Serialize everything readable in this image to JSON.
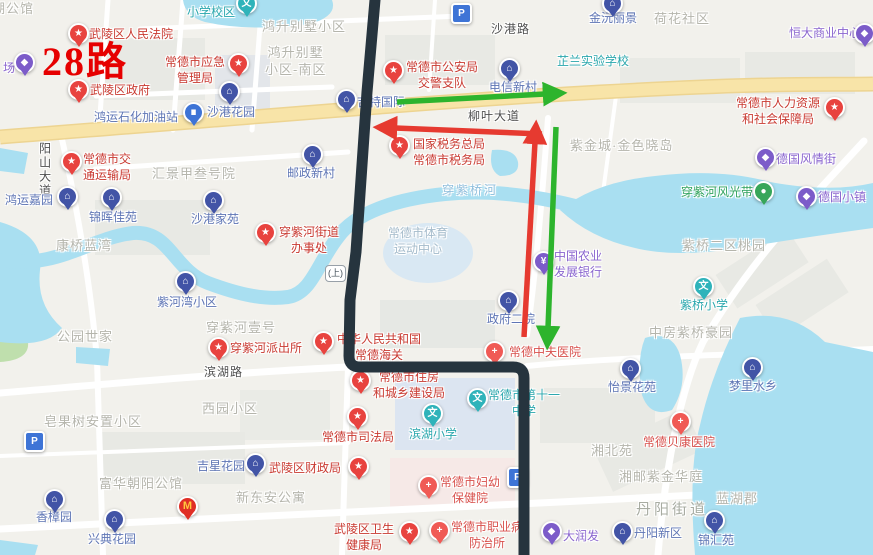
{
  "route_overlay": {
    "route_number": "28路",
    "bridge_badge": "(上)",
    "colors": {
      "route_line": "#26343E",
      "arrow_red": "#E63A30",
      "arrow_green": "#2DB42D",
      "water": "#A9DFF1",
      "major_road": "#F8E4A8",
      "land": "#F2F1EC"
    }
  },
  "labels": [
    {
      "t": "湖公馆",
      "k": "area",
      "x": -8,
      "y": 1
    },
    {
      "t": "场",
      "k": "shop",
      "x": 3,
      "y": 61,
      "px": 24,
      "py": 62
    },
    {
      "t": "28路",
      "k": "route-badge",
      "x": 42,
      "y": 36
    },
    {
      "t": "武陵区人民法院",
      "k": "gov",
      "x": 89,
      "y": 27,
      "px": 78,
      "py": 33
    },
    {
      "t": "常德市应急\n管理局",
      "k": "gov",
      "x": 165,
      "y": 55,
      "px": 238,
      "py": 63
    },
    {
      "t": "武陵区政府",
      "k": "gov",
      "x": 90,
      "y": 83,
      "px": 78,
      "py": 89
    },
    {
      "t": "鸿运石化加油站",
      "k": "gas",
      "x": 94,
      "y": 110,
      "px": 193,
      "py": 112
    },
    {
      "t": "沙港花园",
      "k": "resid",
      "x": 207,
      "y": 105,
      "px": 229,
      "py": 91
    },
    {
      "t": "小学校区",
      "k": "school",
      "x": 187,
      "y": 5,
      "px": 246,
      "py": 3
    },
    {
      "t": "鸿升别墅小区",
      "k": "area",
      "x": 262,
      "y": 19
    },
    {
      "t": "鸿升别墅\n小区-南区",
      "k": "area",
      "x": 265,
      "y": 45
    },
    {
      "t": "沙港路",
      "k": "road",
      "x": 491,
      "y": 22
    },
    {
      "t": "金沅丽景",
      "k": "resid",
      "x": 589,
      "y": 11,
      "px": 612,
      "py": 3
    },
    {
      "t": "荷花社区",
      "k": "area",
      "x": 654,
      "y": 11
    },
    {
      "t": "恒大商业中心",
      "k": "shop",
      "x": 789,
      "y": 26,
      "px": 864,
      "py": 33
    },
    {
      "t": "芷兰实验学校",
      "k": "school",
      "x": 557,
      "y": 54
    },
    {
      "t": "常德市公安局\n交警支队",
      "k": "gov",
      "x": 406,
      "y": 60,
      "px": 393,
      "py": 70
    },
    {
      "t": "吉特国际",
      "k": "resid",
      "x": 357,
      "y": 95,
      "px": 346,
      "py": 99
    },
    {
      "t": "电信新村",
      "k": "resid",
      "x": 489,
      "y": 80,
      "px": 509,
      "py": 68
    },
    {
      "t": "柳叶大道",
      "k": "road",
      "x": 468,
      "y": 109
    },
    {
      "t": "常德市人力资源\n和社会保障局",
      "k": "gov",
      "x": 736,
      "y": 96,
      "px": 834,
      "py": 107
    },
    {
      "t": "紫金城·金色晓岛",
      "k": "area",
      "x": 570,
      "y": 138
    },
    {
      "t": "德国风情街",
      "k": "shop",
      "x": 776,
      "y": 152,
      "px": 765,
      "py": 157
    },
    {
      "t": "穿紫河风光带",
      "k": "scenic",
      "x": 681,
      "y": 185,
      "px": 763,
      "py": 191
    },
    {
      "t": "德国小镇",
      "k": "shop",
      "x": 818,
      "y": 190,
      "px": 806,
      "py": 196
    },
    {
      "t": "阳山大道",
      "k": "road-v",
      "x": 36,
      "y": 142
    },
    {
      "t": "常德市交\n通运输局",
      "k": "gov",
      "x": 83,
      "y": 152,
      "px": 71,
      "py": 161
    },
    {
      "t": "汇景甲叁号院",
      "k": "area",
      "x": 152,
      "y": 166
    },
    {
      "t": "邮政新村",
      "k": "resid",
      "x": 287,
      "y": 166,
      "px": 312,
      "py": 154
    },
    {
      "t": "国家税务总局\n常德市税务局",
      "k": "gov",
      "x": 413,
      "y": 137,
      "px": 399,
      "py": 145
    },
    {
      "t": "穿紫桥河",
      "k": "water",
      "x": 442,
      "y": 183
    },
    {
      "t": "鸿运嘉园",
      "k": "resid",
      "x": 5,
      "y": 193,
      "px": 67,
      "py": 196
    },
    {
      "t": "锦晖佳苑",
      "k": "resid",
      "x": 89,
      "y": 210,
      "px": 111,
      "py": 197
    },
    {
      "t": "沙港家苑",
      "k": "resid",
      "x": 191,
      "y": 212,
      "px": 213,
      "py": 200
    },
    {
      "t": "穿紫河街道\n办事处",
      "k": "gov",
      "x": 279,
      "y": 225,
      "px": 265,
      "py": 232
    },
    {
      "t": "康桥蓝湾",
      "k": "area",
      "x": 56,
      "y": 238
    },
    {
      "t": "常德市体育\n运动中心",
      "k": "venue",
      "x": 388,
      "y": 226
    },
    {
      "t": "中国农业\n发展银行",
      "k": "bank",
      "x": 554,
      "y": 249,
      "px": 543,
      "py": 261
    },
    {
      "t": "紫桥二区桃园",
      "k": "area",
      "x": 682,
      "y": 238
    },
    {
      "t": "紫河湾小区",
      "k": "resid",
      "x": 157,
      "y": 295,
      "px": 185,
      "py": 281
    },
    {
      "t": "紫桥小学",
      "k": "school",
      "x": 680,
      "y": 298,
      "px": 703,
      "py": 286
    },
    {
      "t": "政府二院",
      "k": "resid",
      "x": 487,
      "y": 312,
      "px": 508,
      "py": 300
    },
    {
      "t": "公园世家",
      "k": "area",
      "x": 57,
      "y": 329
    },
    {
      "t": "穿紫河壹号",
      "k": "area",
      "x": 206,
      "y": 320
    },
    {
      "t": "穿紫河派出所",
      "k": "gov",
      "x": 230,
      "y": 341,
      "px": 218,
      "py": 347
    },
    {
      "t": "中华人民共和国\n常德海关",
      "k": "gov",
      "x": 337,
      "y": 332,
      "px": 323,
      "py": 341
    },
    {
      "t": "常德中夫医院",
      "k": "hosp",
      "x": 509,
      "y": 345,
      "px": 494,
      "py": 351
    },
    {
      "t": "中房紫桥豪园",
      "k": "area",
      "x": 649,
      "y": 325
    },
    {
      "t": "滨湖路",
      "k": "road",
      "x": 204,
      "y": 365
    },
    {
      "t": "西园小区",
      "k": "area",
      "x": 202,
      "y": 401
    },
    {
      "t": "常德市住房\n和城乡建设局",
      "k": "gov",
      "x": 373,
      "y": 370,
      "px": 360,
      "py": 380
    },
    {
      "t": "常德市第十一\n中学",
      "k": "school",
      "x": 488,
      "y": 388,
      "px": 477,
      "py": 398
    },
    {
      "t": "滨湖小学",
      "k": "school",
      "x": 409,
      "y": 427,
      "px": 432,
      "py": 413
    },
    {
      "t": "怡景花苑",
      "k": "resid",
      "x": 608,
      "y": 380,
      "px": 630,
      "py": 368
    },
    {
      "t": "梦里水乡",
      "k": "resid",
      "x": 729,
      "y": 379,
      "px": 752,
      "py": 367
    },
    {
      "t": "皂果树安置小区",
      "k": "area",
      "x": 44,
      "y": 414
    },
    {
      "t": "常德市司法局",
      "k": "gov",
      "x": 322,
      "y": 430,
      "px": 357,
      "py": 416
    },
    {
      "t": "常德贝康医院",
      "k": "hosp",
      "x": 643,
      "y": 435,
      "px": 680,
      "py": 421
    },
    {
      "t": "湘北苑",
      "k": "area",
      "x": 591,
      "y": 443
    },
    {
      "t": "吉星花园",
      "k": "resid",
      "x": 197,
      "y": 459,
      "px": 255,
      "py": 463
    },
    {
      "t": "武陵区财政局",
      "k": "gov",
      "x": 269,
      "y": 461,
      "px": 358,
      "py": 466
    },
    {
      "t": "湘邮紫金华庭",
      "k": "area",
      "x": 619,
      "y": 469
    },
    {
      "t": "富华朝阳公馆",
      "k": "area",
      "x": 99,
      "y": 476
    },
    {
      "t": "新东安公寓",
      "k": "area",
      "x": 236,
      "y": 490
    },
    {
      "t": "常德市妇幼\n保健院",
      "k": "hosp",
      "x": 440,
      "y": 475,
      "px": 428,
      "py": 485
    },
    {
      "t": "蓝湖郡",
      "k": "area",
      "x": 716,
      "y": 491
    },
    {
      "t": "丹阳街道",
      "k": "area-lg",
      "x": 636,
      "y": 500
    },
    {
      "t": "香樟园",
      "k": "resid",
      "x": 36,
      "y": 510,
      "px": 54,
      "py": 499
    },
    {
      "t": "兴典花园",
      "k": "resid",
      "x": 88,
      "y": 532,
      "px": 114,
      "py": 519
    },
    {
      "t": "丹阳新区",
      "k": "resid",
      "x": 634,
      "y": 526,
      "px": 622,
      "py": 531
    },
    {
      "t": "锦汇苑",
      "k": "resid",
      "x": 698,
      "y": 533,
      "px": 714,
      "py": 520
    },
    {
      "t": "大润发",
      "k": "shop",
      "x": 563,
      "y": 529,
      "px": 551,
      "py": 531
    },
    {
      "t": "武陵区卫生\n健康局",
      "k": "gov",
      "x": 334,
      "y": 522,
      "px": 409,
      "py": 531
    },
    {
      "t": "常德市职业病\n防治所",
      "k": "hosp",
      "x": 451,
      "y": 520,
      "px": 439,
      "py": 530
    },
    {
      "t": "",
      "k": "mcd",
      "px": 187,
      "py": 506
    },
    {
      "t": "",
      "k": "parking",
      "px": 461,
      "py": 13
    },
    {
      "t": "",
      "k": "parking",
      "px": 34,
      "py": 441
    },
    {
      "t": "",
      "k": "parking",
      "px": 517,
      "py": 477
    },
    {
      "t": "(上)",
      "k": "bridge",
      "x": 325,
      "y": 265
    }
  ]
}
